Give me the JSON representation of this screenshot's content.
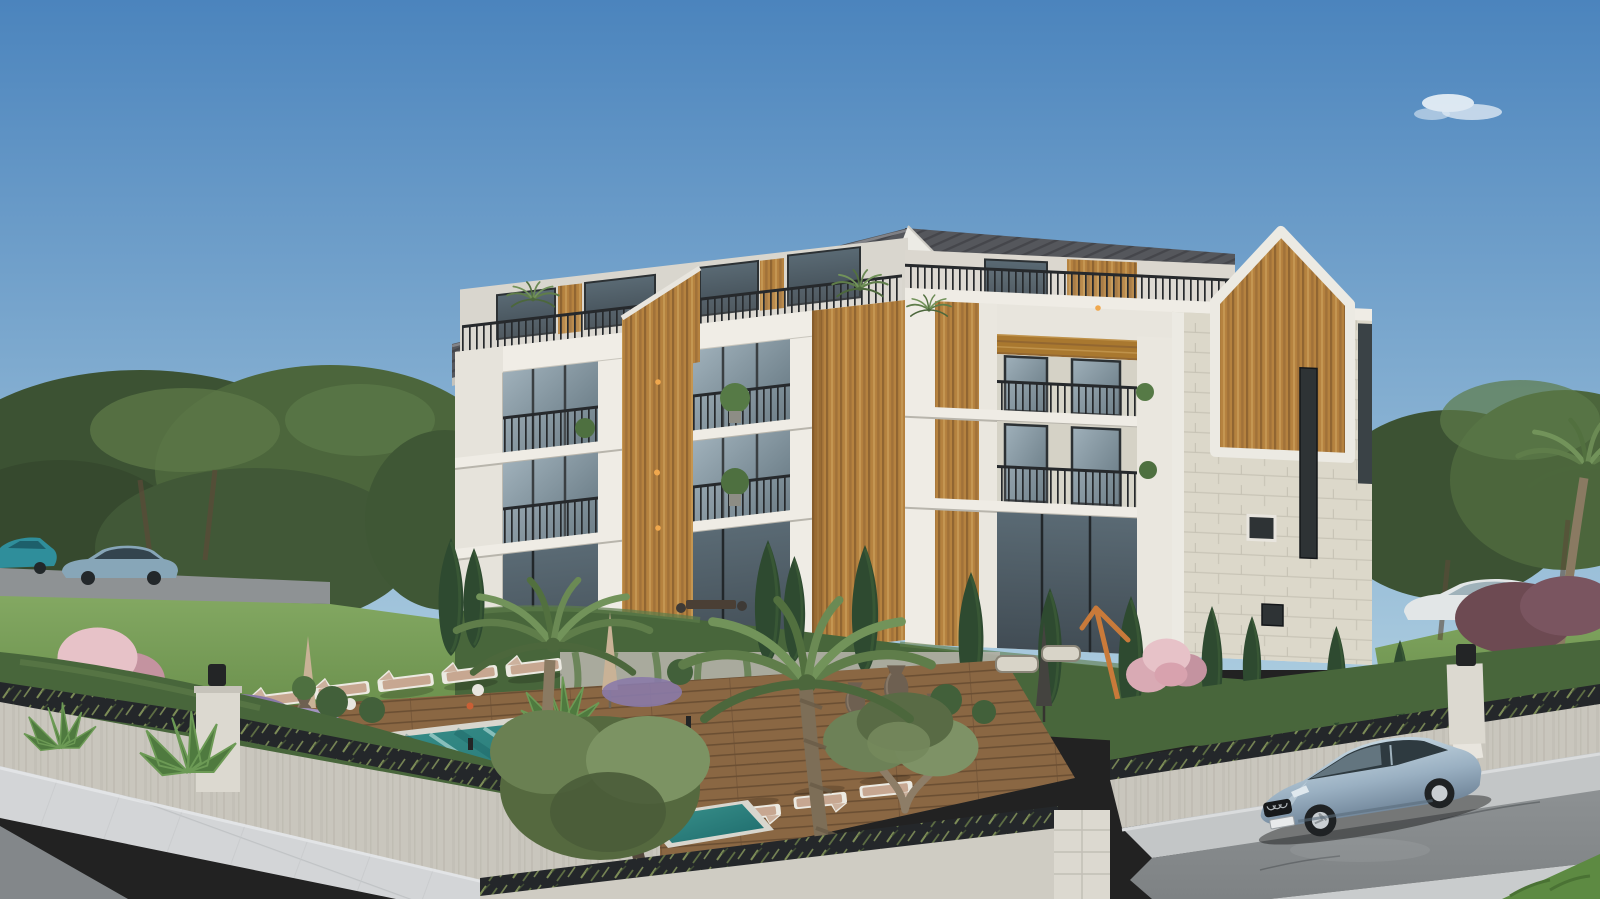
{
  "scene": {
    "title": "Exterior 3D render of a modern 4-storey apartment residence with garden, pool and street",
    "labels": {
      "sky": "clear blue sky with one small cloud",
      "building": "white concrete apartment building with wood-slat accents and dark gabled metal roof",
      "gable": "stone-clad end wall with pentagonal wood panel",
      "balconies": "recessed balconies with black picket railings and glass doors",
      "pool": "turquoise swimming pool with wooden sun deck",
      "loungers": "white sun loungers with tan cushions",
      "garden": "landscaped garden with palms, cypresses, olive trees, lavender and pink blossom trees",
      "wall": "stone perimeter wall topped with dark decorative lattice panels and lamp pillars",
      "road_right": "asphalt street with parked silver-blue Audi sedan",
      "road_left": "street with two distant parked cars",
      "lawn": "green lawn with mature trees"
    },
    "colors": {
      "skyTop": "#4b84bd",
      "skyHorizon": "#a9cade",
      "cloudWhite": "#f4f8fb",
      "treeDark": "#3c5233",
      "treeMid": "#4c663c",
      "treeLight": "#5d7a48",
      "grass": "#6a8f4c",
      "grassLight": "#83a862",
      "roofDark": "#55575c",
      "roofRib": "#45464b",
      "facadeWhite": "#eae7e0",
      "facadeBand": "#f0ede6",
      "facadeShade": "#c6c3ba",
      "glassLight": "#9fb0ba",
      "glassDark": "#414c54",
      "wood": "#b5823f",
      "woodDark": "#8a6030",
      "woodLight": "#cda35c",
      "railing": "#26292c",
      "stone": "#dcd8ca",
      "stoneLine": "#c8c4b6",
      "hedge": "#48663b",
      "hedgeLight": "#5d7c4a",
      "cypress": "#2e4a30",
      "palmFrond": "#5f7d4a",
      "oliveLeaf": "#6d8157",
      "blossomPink": "#d9aab4",
      "lavender": "#988cb6",
      "poolTeal": "#3b948e",
      "poolDeep": "#1d6a6b",
      "poolStreak": "#cfeeea",
      "coping": "#d8d6ce",
      "deck": "#8a6743",
      "deckLine": "#6b4f33",
      "wallFace": "#c9c6bd",
      "wallLight": "#d5d2c9",
      "lattice": "#24272a",
      "pillar": "#dcd9d0",
      "sidewalk": "#d3d5d7",
      "asphalt": "#7e8284",
      "asphaltLight": "#8d9193",
      "carSilver": "#9ab0c2",
      "carWindow": "#2e3a40",
      "trunkBrown": "#8a7a62",
      "bronze": "#6e6051",
      "cushionTan": "#c7a791",
      "loungerWhite": "#eceae2",
      "amber": "#f0a84e"
    }
  }
}
